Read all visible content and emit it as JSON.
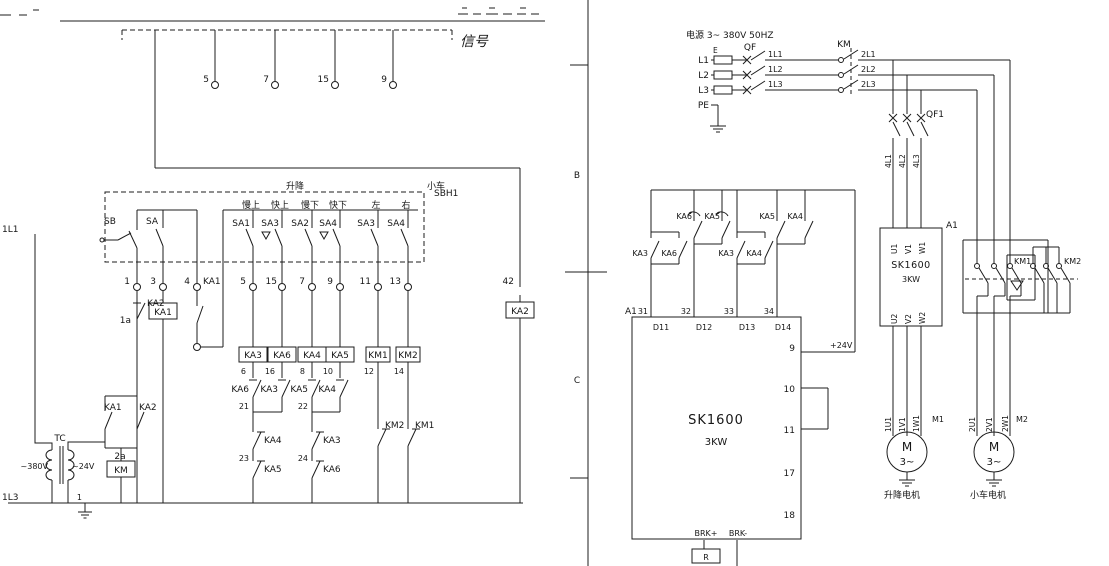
{
  "colors": {
    "ink": "#1c1c1c",
    "sk_label": "#2b2b8f"
  },
  "left_sheet": {
    "signal_box": {
      "caption": "信号",
      "terminals": [
        "5",
        "7",
        "15",
        "9"
      ]
    },
    "pendant": {
      "id": "SBH1",
      "group_labels": [
        "升降",
        "小车"
      ],
      "function_labels": [
        "慢上",
        "快上",
        "慢下",
        "快下",
        "左",
        "右"
      ],
      "master_switches": [
        "SB",
        "SA"
      ],
      "switches": [
        "SA1",
        "SA3",
        "SA2",
        "SA4",
        "SA3",
        "SA4"
      ],
      "terminal_numbers": [
        "1",
        "3",
        "4",
        "5",
        "15",
        "7",
        "9",
        "11",
        "13"
      ]
    },
    "rung_stop": {
      "contact": "KA2",
      "wire": "1a"
    },
    "rung_master": {
      "coil": "KA1"
    },
    "rung_hold": {
      "contact": "KA1"
    },
    "relay_rungs": {
      "coils": [
        "KA3",
        "KA6",
        "KA4",
        "KA5"
      ],
      "coil_wires": [
        "6",
        "16",
        "8",
        "10"
      ],
      "first_interlocks": [
        "KA6",
        "KA3",
        "KA5",
        "KA4"
      ],
      "merge_wires": [
        "21",
        "22"
      ],
      "second_interlocks": [
        "KA4",
        "KA3"
      ],
      "third_wires": [
        "23",
        "24"
      ],
      "third_interlocks": [
        "KA5",
        "KA6"
      ]
    },
    "contactor_rungs": {
      "coils": [
        "KM1",
        "KM2"
      ],
      "wires": [
        "12",
        "14"
      ],
      "interlocks": [
        "KM2",
        "KM1"
      ]
    },
    "rung_ka2": {
      "terminal": "42",
      "coil": "KA2"
    },
    "rung_km": {
      "contacts": [
        "KA1",
        "KA2"
      ],
      "wire": "2a",
      "coil": "KM"
    },
    "transformer": {
      "id": "TC",
      "primary": "~380V",
      "secondary": "~24V",
      "line_top": "1L1",
      "line_bottom": "1L3",
      "ground_wire": "1"
    }
  },
  "right_sheet": {
    "zone_b": "B",
    "zone_c": "C",
    "supply": {
      "caption": "电源 3~ 380V 50HZ",
      "phases": [
        "L1",
        "L2",
        "L3",
        "PE"
      ],
      "terminal_mark": "E",
      "breaker": "QF",
      "stage1_wires": [
        "1L1",
        "1L2",
        "1L3"
      ],
      "contactor": "KM",
      "stage2_wires": [
        "2L1",
        "2L2",
        "2L3"
      ],
      "branch_breaker": "QF1",
      "branch_wires": [
        "4L1",
        "4L2",
        "4L3"
      ]
    },
    "inverter": {
      "id": "A1",
      "model": "SK1600",
      "rating": "3KW",
      "input_terminals": [
        "U1",
        "V1",
        "W1"
      ],
      "output_terminals": [
        "U2",
        "V2",
        "W2"
      ]
    },
    "selectors": {
      "left": "KM1",
      "right": "KM2"
    },
    "motor1": {
      "wires": [
        "1U1",
        "1V1",
        "1W1"
      ],
      "id": "M1",
      "letter": "M",
      "phases": "3~",
      "caption": "升降电机"
    },
    "motor2": {
      "wires": [
        "2U1",
        "2V1",
        "2W1"
      ],
      "id": "M2",
      "letter": "M",
      "phases": "3~",
      "caption": "小车电机"
    },
    "controller": {
      "model": "SK1600",
      "rating": "3KW",
      "board": "A1",
      "input_wires": [
        "31",
        "32",
        "33",
        "34"
      ],
      "input_pins": [
        "D11",
        "D12",
        "D13",
        "D14"
      ],
      "side_pins": [
        "9",
        "10",
        "11",
        "17",
        "18"
      ],
      "supply_label": "+24V",
      "brake_pins": [
        "BRK+",
        "BRK-"
      ],
      "resistor": "R",
      "contact_pairs": {
        "p1": [
          "KA3",
          "KA6"
        ],
        "p2": [
          "KA6",
          "KA5"
        ],
        "p3": [
          "KA3",
          "KA4"
        ],
        "p4": [
          "KA5",
          "KA4"
        ]
      }
    }
  }
}
